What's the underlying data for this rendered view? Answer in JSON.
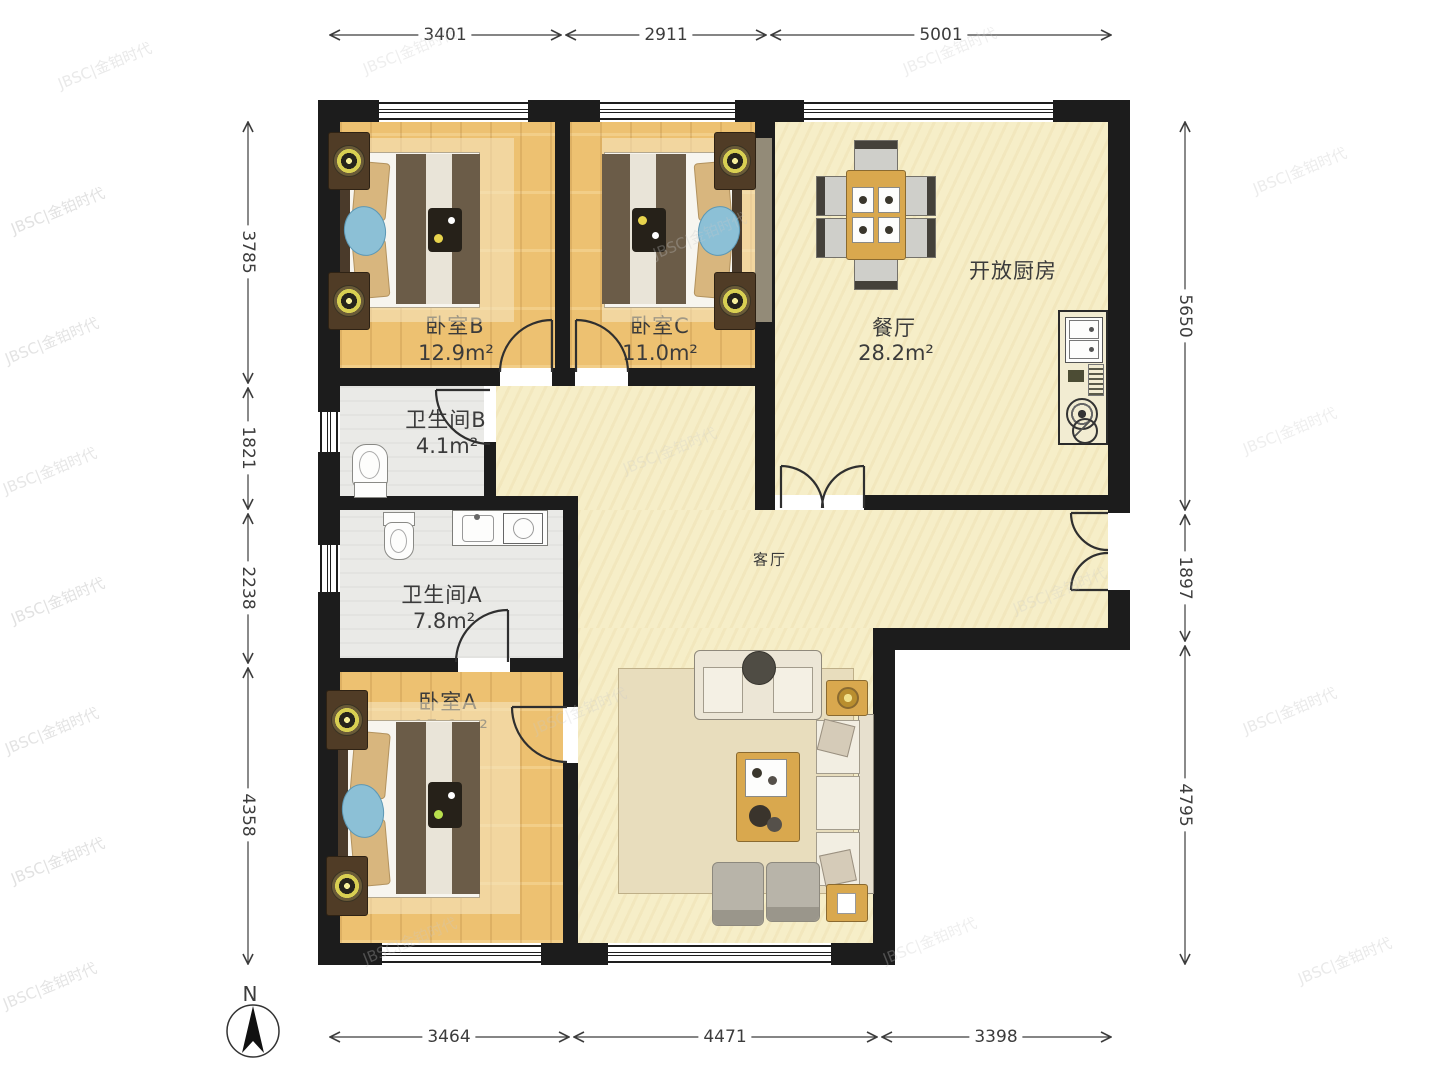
{
  "plan": {
    "watermark": "JBSC|金铂时代",
    "north_label": "N"
  },
  "rooms": {
    "bedroom_b": {
      "name": "卧室B",
      "area": "12.9m²"
    },
    "bedroom_c": {
      "name": "卧室C",
      "area": "11.0m²"
    },
    "bedroom_a": {
      "name": "卧室A",
      "area": "15.1m²"
    },
    "bathroom_b": {
      "name": "卫生间B",
      "area": "4.1m²"
    },
    "bathroom_a": {
      "name": "卫生间A",
      "area": "7.8m²"
    },
    "dining": {
      "name": "餐厅",
      "area": "28.2m²"
    },
    "kitchen": {
      "name": "开放厨房"
    },
    "living": {
      "name": "客厅"
    }
  },
  "dimensions": {
    "top": [
      "3401",
      "2911",
      "5001"
    ],
    "bottom": [
      "3464",
      "4471",
      "3398"
    ],
    "left": [
      "3785",
      "1821",
      "2238",
      "4358"
    ],
    "right": [
      "5650",
      "1897",
      "4795"
    ]
  }
}
